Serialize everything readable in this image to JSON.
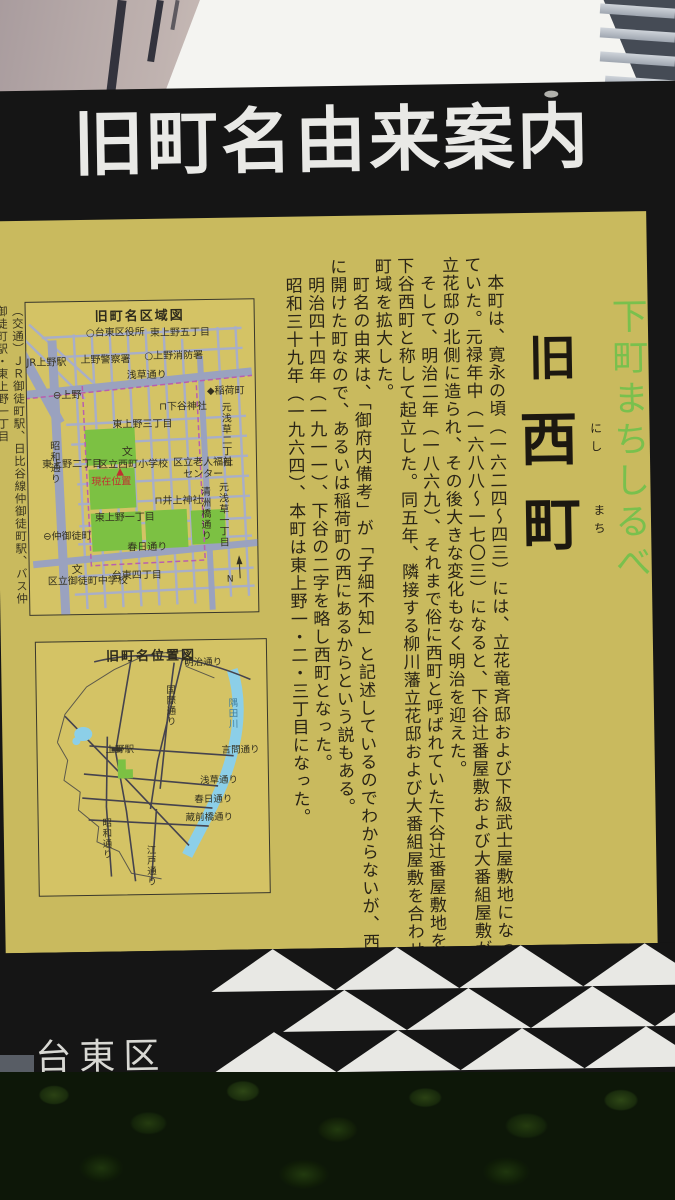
{
  "sign": {
    "header_title": "旧町名由来案内",
    "tagline": "下町まちしるべ",
    "old_name": {
      "prefix": "旧",
      "char1": "西",
      "char1_furigana": "にし",
      "char2": "町",
      "char2_furigana": "まち"
    },
    "body_paragraphs": [
      "本町は、寛永の頃（一六二四～四三）には、立花竜斉邸および下級武士屋敷地になっていた。元禄年中（一六八八～一七〇三）になると、下谷辻番屋敷および大番組屋敷が立花邸の北側に造られ、その後大きな変化もなく明治を迎えた。",
      "そして、明治二年（一八六九）、それまで俗に西町と呼ばれていた下谷辻番屋敷地を下谷西町と称して起立した。同五年、隣接する柳川藩立花邸および大番組屋敷を合わせ町域を拡大した。",
      "町名の由来は、「御府内備考」が「子細不知」と記述しているのでわからないが、西に開けた町なので、あるいは稲荷町の西にあるからという説もある。",
      "明治四十四年（一九一一）、下谷の二字を略し西町となった。",
      "昭和三十九年（一九六四）、本町は東上野一・二・三丁目になった。"
    ],
    "access_note": "（交通）ＪＲ御徒町駅、日比谷線仲御徒町駅、バス仲御徒町駅・東上野一丁目",
    "footer_ward": "台東区",
    "colors": {
      "panel_yellow": "#c9ba5e",
      "frame_black": "#151515",
      "header_text": "#e9e9e6",
      "tagline_green": "#79c04d",
      "map_block_green": "#7cc143",
      "map_road_blue": "#a8aec8",
      "river_blue": "#8ccfe8",
      "boundary_purple": "#b95fae",
      "marker_red": "#c03030"
    },
    "area_map": {
      "title": "旧町名区域図",
      "labels": [
        {
          "text": "○台東区役所",
          "x": 60,
          "y": 27
        },
        {
          "text": "東上野五丁目",
          "x": 124,
          "y": 28
        },
        {
          "text": "上野警察署",
          "x": 54,
          "y": 54
        },
        {
          "text": "○上野消防署",
          "x": 118,
          "y": 51
        },
        {
          "text": "JR上野駅",
          "x": 0,
          "y": 56
        },
        {
          "text": "浅草通り",
          "x": 100,
          "y": 70
        },
        {
          "text": "⊖上野",
          "x": 26,
          "y": 89,
          "kind": "metro-station-icon"
        },
        {
          "text": "◆稲荷町",
          "x": 180,
          "y": 87,
          "kind": "metro-station-icon"
        },
        {
          "text": "⊓下谷神社",
          "x": 132,
          "y": 102,
          "kind": "shrine-icon"
        },
        {
          "text": "東上野三丁目",
          "x": 85,
          "y": 119
        },
        {
          "text": "元浅草二丁目",
          "x": 192,
          "y": 102,
          "v": 1
        },
        {
          "text": "元浅草一丁目",
          "x": 188,
          "y": 182,
          "v": 1
        },
        {
          "text": "昭和通り",
          "x": 20,
          "y": 138,
          "v": 1
        },
        {
          "text": "東上野二丁目",
          "x": 14,
          "y": 158
        },
        {
          "text": "文",
          "x": 94,
          "y": 145,
          "kind": "school-icon",
          "fs": 11
        },
        {
          "text": "区立西町小学校",
          "x": 70,
          "y": 159
        },
        {
          "text": "▲",
          "x": 88,
          "y": 166,
          "c": "#c03030",
          "kind": "current-location-marker"
        },
        {
          "text": "現在位置",
          "x": 63,
          "y": 176,
          "c": "#c03030",
          "kind": "current-location-label"
        },
        {
          "text": "区立老人福祉",
          "x": 145,
          "y": 158
        },
        {
          "text": "センター",
          "x": 155,
          "y": 170
        },
        {
          "text": "⊓井上神社",
          "x": 126,
          "y": 196,
          "kind": "shrine-icon"
        },
        {
          "text": "東上野一丁目",
          "x": 66,
          "y": 212
        },
        {
          "text": "清洲橋通り",
          "x": 170,
          "y": 186,
          "v": 1
        },
        {
          "text": "⊖仲御徒町",
          "x": 14,
          "y": 230,
          "kind": "metro-station-icon"
        },
        {
          "text": "春日通り",
          "x": 98,
          "y": 242
        },
        {
          "text": "台東四丁目",
          "x": 82,
          "y": 270
        },
        {
          "text": "文",
          "x": 42,
          "y": 262,
          "kind": "school-icon",
          "fs": 11
        },
        {
          "text": "区立御徒町中学校",
          "x": 18,
          "y": 275
        },
        {
          "text": "N",
          "x": 197,
          "y": 276,
          "kind": "compass-north",
          "fs": 9
        }
      ]
    },
    "location_map": {
      "title": "旧町名位置図",
      "labels": [
        {
          "text": "明治通り",
          "x": 148,
          "y": 18
        },
        {
          "text": "国際通り",
          "x": 128,
          "y": 44,
          "v": 1
        },
        {
          "text": "隅田川",
          "x": 190,
          "y": 58,
          "v": 1,
          "c": "#41809f"
        },
        {
          "text": "言問通り",
          "x": 184,
          "y": 106
        },
        {
          "text": "上野駅",
          "x": 68,
          "y": 104
        },
        {
          "text": "浅草通り",
          "x": 162,
          "y": 136
        },
        {
          "text": "春日通り",
          "x": 156,
          "y": 155
        },
        {
          "text": "蔵前橋通り",
          "x": 147,
          "y": 173
        },
        {
          "text": "昭和通り",
          "x": 62,
          "y": 176,
          "v": 1
        },
        {
          "text": "江戸通り",
          "x": 106,
          "y": 204,
          "v": 1
        }
      ]
    }
  }
}
